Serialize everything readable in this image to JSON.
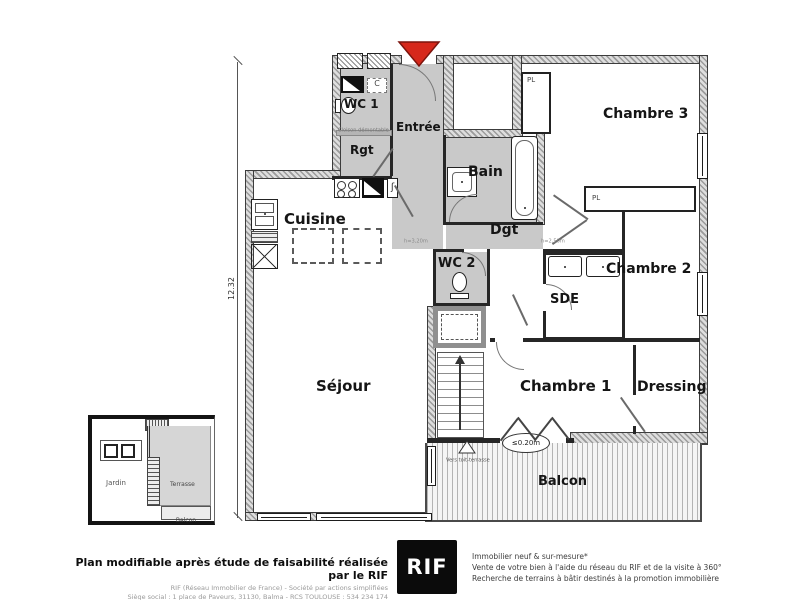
{
  "plan": {
    "rooms": {
      "wc1": "WC 1",
      "rgt": "Rgt",
      "entree": "Entrée",
      "bain": "Bain",
      "chambre3": "Chambre 3",
      "cuisine": "Cuisine",
      "dgt": "Dgt",
      "wc2": "WC 2",
      "sde": "SDE",
      "chambre2": "Chambre 2",
      "sejour": "Séjour",
      "chambre1": "Chambre 1",
      "dressing": "Dressing",
      "balcon": "Balcon"
    },
    "closets": {
      "pl_chambre3": "PL",
      "pl_band": "PL",
      "c_unit": "C"
    },
    "annotations": {
      "cloison": "Cloison démontable",
      "height_entry": "h=3,20m",
      "height_dgt": "h=2,50m",
      "vers_toit": "Vers toit-terrasse",
      "step_level": "≤0.20m",
      "dim_left": "12.32",
      "heater_symbol": "ʃ"
    },
    "inset": {
      "jardin": "Jardin",
      "terrasse": "Terrasse",
      "balcon": "Balcon"
    }
  },
  "footer": {
    "disclaimer_title": "Plan modifiable après étude de faisabilité réalisée par le RIF",
    "company_line": "RIF (Réseau Immobilier de France) - Société par actions simplifiées",
    "address_line": "Siège social : 1 place de Paveurs, 31130, Balma - RCS TOULOUSE : 534 234 174",
    "logo": "RIF",
    "service1": "Immobilier neuf & sur-mesure*",
    "service2": "Vente de votre bien à l'aide du réseau du RIF et de la visite à 360°",
    "service3": "Recherche de terrains à bâtir destinés à la promotion immobilière"
  },
  "colors": {
    "entrance_marker": "#d6281b",
    "wall": "#9b9b9b",
    "circulation_floor": "#c9c9c9"
  }
}
